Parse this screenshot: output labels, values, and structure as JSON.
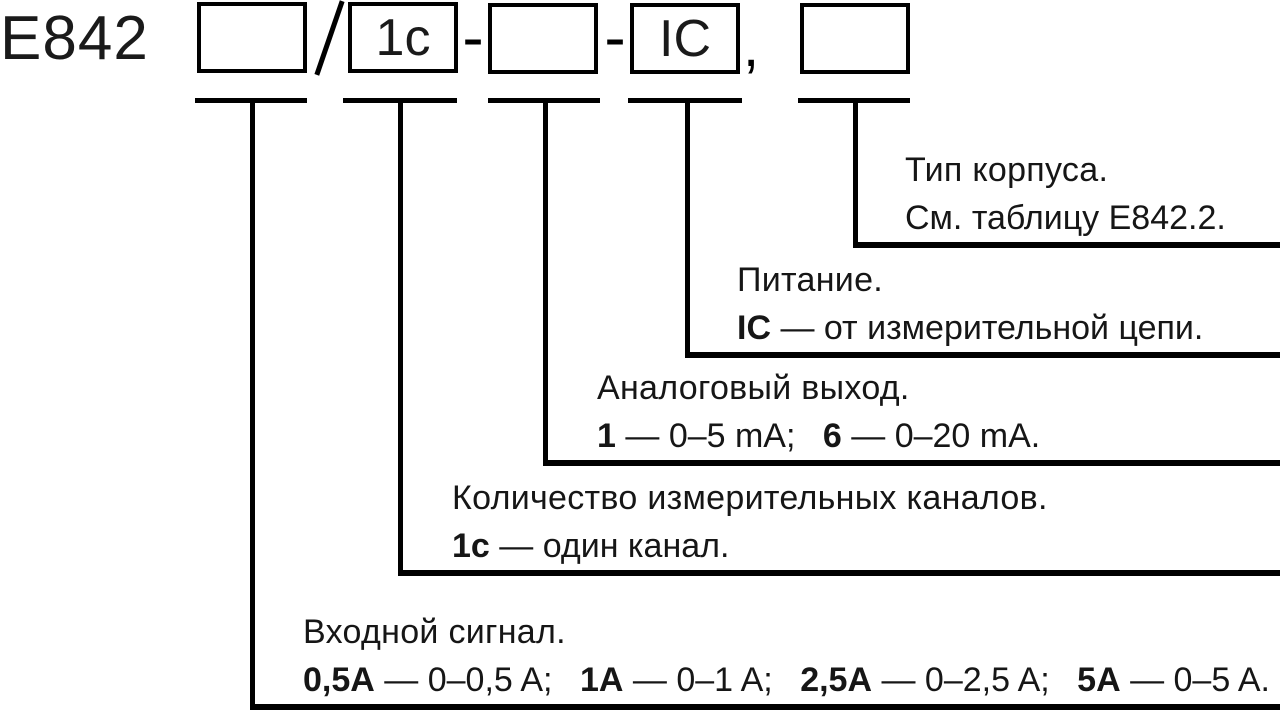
{
  "page": {
    "background": "#ffffff",
    "line_color": "#000000",
    "text_color": "#161616"
  },
  "formula": {
    "prefix": "Е842",
    "boxes": [
      {
        "value": ""
      },
      {
        "value": "1c"
      },
      {
        "value": ""
      },
      {
        "value": "IC"
      },
      {
        "value": ""
      }
    ],
    "separators": {
      "slash": "/",
      "dash1": "-",
      "dash2": "-",
      "comma": ","
    }
  },
  "branches": [
    {
      "field": "housing-type",
      "title": "Тип корпуса.",
      "segments": [
        {
          "code": "",
          "rest": "См. таблицу Е842.2."
        }
      ]
    },
    {
      "field": "power-supply",
      "title": "Питание.",
      "segments": [
        {
          "code": "IC",
          "rest": " — от измерительной цепи."
        }
      ]
    },
    {
      "field": "analog-output",
      "title": "Аналоговый выход.",
      "segments": [
        {
          "code": "1",
          "rest": " — 0–5 mA;"
        },
        {
          "code": "6",
          "rest": " — 0–20 mA."
        }
      ]
    },
    {
      "field": "channel-count",
      "title": "Количество измерительных каналов.",
      "segments": [
        {
          "code": "1c",
          "rest": " — один канал."
        }
      ]
    },
    {
      "field": "input-signal",
      "title": "Входной сигнал.",
      "segments": [
        {
          "code": "0,5A",
          "rest": " — 0–0,5 A;"
        },
        {
          "code": "1A",
          "rest": " — 0–1 A;"
        },
        {
          "code": "2,5A",
          "rest": " — 0–2,5 A;"
        },
        {
          "code": "5A",
          "rest": " — 0–5 A."
        }
      ]
    }
  ]
}
